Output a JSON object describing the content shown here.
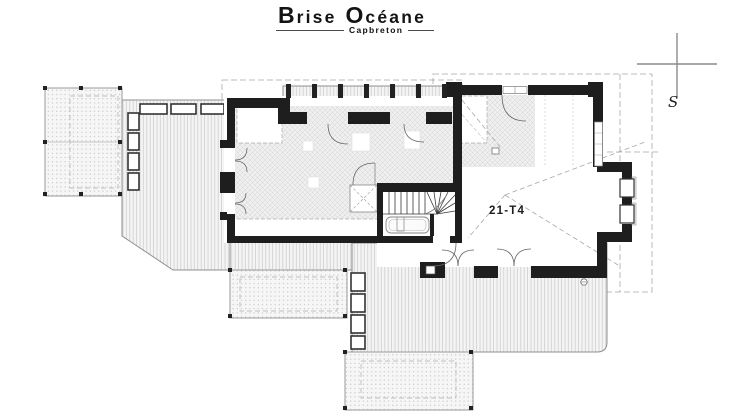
{
  "header": {
    "title": "Brise Océane",
    "title_b1": "B",
    "title_r1": "rise",
    "title_b2": "O",
    "title_r2": "céane",
    "subtitle": "Capbreton"
  },
  "plan": {
    "unit_label": "21-T4",
    "drawing_type": "floor-plan"
  },
  "compass": {
    "south_label": "S"
  },
  "colors": {
    "wall": "#1e1e1e",
    "deck_line": "#c9c9c9",
    "hatch_line": "#d6d6d6",
    "dash_line": "#a8a8a8",
    "detail_line": "#666666",
    "background": "#ffffff"
  }
}
